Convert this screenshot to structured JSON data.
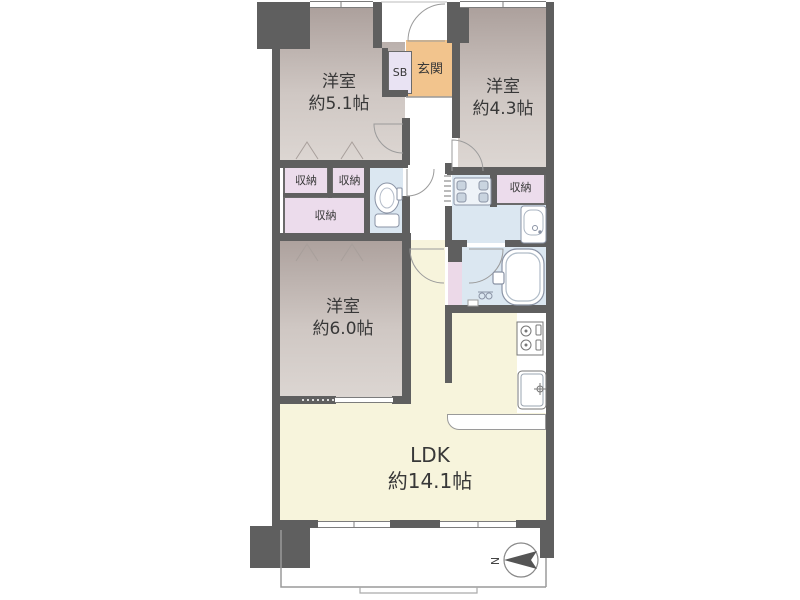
{
  "meta": {
    "type": "apartment-floor-plan"
  },
  "colors": {
    "wall": "#5f5f5f",
    "roomDark": "#ab9f9b",
    "roomLight": "#ddd7d3",
    "ldk": "#f7f4dc",
    "wet": "#dbe7f1",
    "closet": "#ecdcec",
    "pinkStrip": "#ecd9e8",
    "genkan": "#f2c48d",
    "sb": "#e9e3f3",
    "text": "#383838"
  },
  "rooms": {
    "room51": {
      "name": "洋室",
      "size": "約5.1帖"
    },
    "room43": {
      "name": "洋室",
      "size": "約4.3帖"
    },
    "room60": {
      "name": "洋室",
      "size": "約6.0帖"
    },
    "ldk": {
      "name": "LDK",
      "size": "約14.1帖"
    },
    "genkan": {
      "label": "玄関"
    },
    "shoebox": {
      "label": "SB"
    },
    "closet1": {
      "label": "収納"
    },
    "closet2": {
      "label": "収納"
    },
    "closet3": {
      "label": "収納"
    },
    "closet4": {
      "label": "収納"
    }
  },
  "compass": {
    "north": "N"
  },
  "fixtures": [
    "entrance-door",
    "toilet",
    "washbasin",
    "washing-machine-pan",
    "bathtub",
    "gas-stove",
    "kitchen-sink",
    "kitchen-counter",
    "balcony"
  ]
}
